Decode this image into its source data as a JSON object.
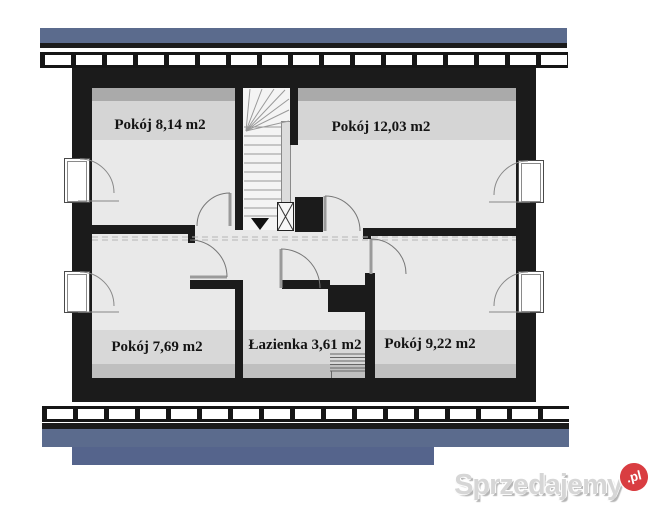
{
  "plan": {
    "type": "floor-plan",
    "floor": "attic storey",
    "rooms": [
      {
        "name": "room-top-left",
        "label": "Pokój 8,14 m2"
      },
      {
        "name": "room-top-right",
        "label": "Pokój 12,03 m2"
      },
      {
        "name": "room-bottom-left",
        "label": "Pokój 7,69 m2"
      },
      {
        "name": "bathroom",
        "label": "Łazienka 3,61 m2"
      },
      {
        "name": "room-bottom-right",
        "label": "Pokój 9,22 m2"
      }
    ],
    "features": [
      "staircase-with-down-arrow",
      "chimney-hatch-box",
      "four-inward-opening-windows",
      "five-door-swings",
      "bathroom-radiator",
      "knee-wall-dashed-line"
    ],
    "colors": {
      "roof_blue": "#5b6b8d",
      "roof_blue_dark": "#55648c",
      "wall_black": "#1b1b1b",
      "floor_light": "#e9e9e9",
      "band_mid": "#d5d5d5",
      "band_dark": "#aaaaaa",
      "badge_red": "#d93d41"
    }
  },
  "watermark": {
    "brand": "Sprzedajemy",
    "tld": ".pl"
  }
}
